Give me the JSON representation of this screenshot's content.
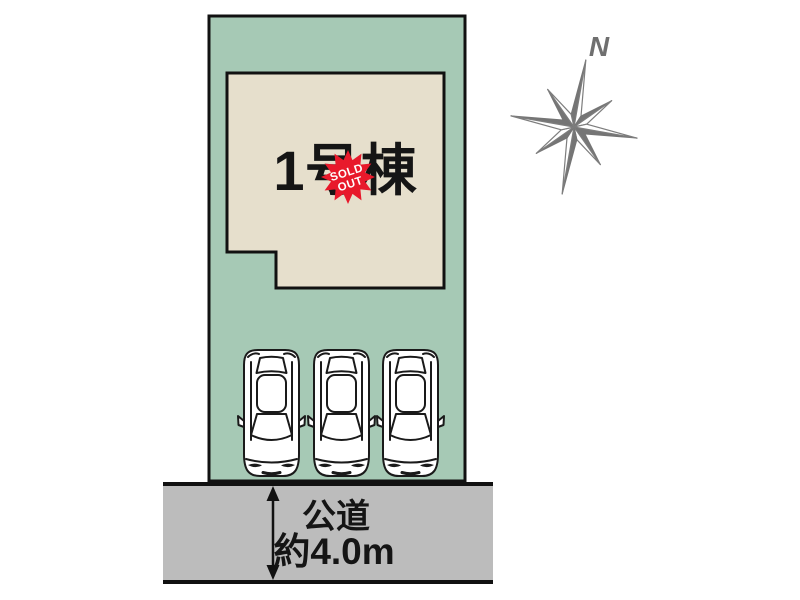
{
  "colors": {
    "plot_green": "#a6c9b5",
    "building_beige": "#e6dfcc",
    "road_gray": "#bcbcbc",
    "outline": "#111111",
    "badge_red": "#e8192b",
    "compass_gray": "#757575",
    "text_black": "#151515"
  },
  "building": {
    "label": "1号棟"
  },
  "badge": {
    "line1": "SOLD",
    "line2": "OUT"
  },
  "road": {
    "name": "公道",
    "width_label": "約4.0m"
  },
  "compass": {
    "north_label": "N"
  },
  "parking": {
    "car_count": 3
  }
}
